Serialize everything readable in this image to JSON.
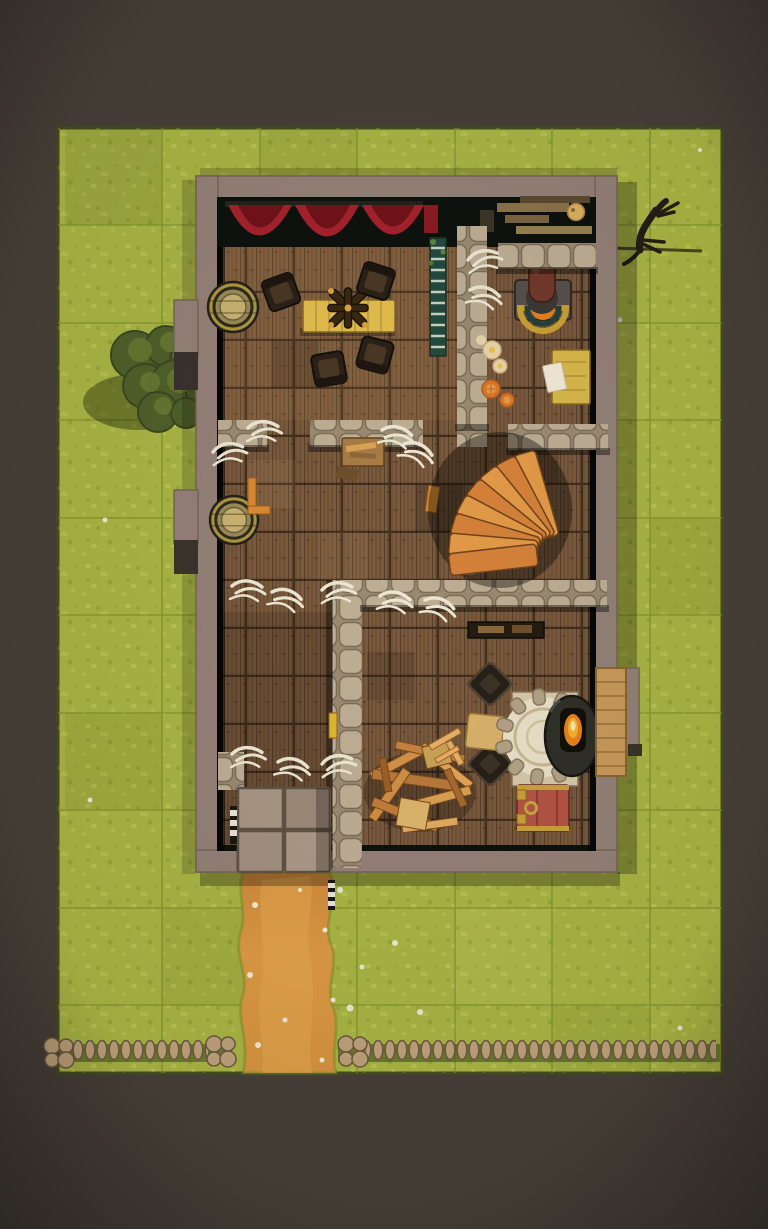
{
  "scene": {
    "description": "Top-down fantasy tavern battle map on a grass field with square grid, dirt path, stone fence, bush and lizard"
  },
  "colors": {
    "backdrop": "#474038",
    "grass": "#a9b544",
    "grass_edge": "#454e20",
    "grid_line": "#7f922c",
    "path": "#d79440",
    "path_light": "#e3a74f",
    "wall": "#93histogram",
    "wall_face": "#94azz",
    "wall_fill": "#948077",
    "wall_shadow": "#3a332c",
    "interior_dark": "#0e100c",
    "floor_wood": "#7b5a3d",
    "stone_mortar": "#9a8a72",
    "stone_face": "#bdae94",
    "curtain": "#a5222c",
    "curtain_dark": "#701219",
    "table_wood": "#e2bd4e",
    "chair_dark": "#2c2118",
    "barrel_wood": "#9a8a58",
    "stair_wood": "#e29a47",
    "copper_pipe": "#73392a",
    "fire": "#e8821c",
    "hearth_base": "#d6c9a8",
    "hearth_inner": "#e9e0c8",
    "stove_iron": "#2f3028",
    "trapdoor_red": "#b35544",
    "brass_trim": "#c9a23c",
    "bench_wood": "#c9995a",
    "slab_stone": "#a29080",
    "fence_stone": "#bfa27b",
    "tree_foliage": "#4f602a",
    "tree_highlight": "#687a33",
    "lizard": "#241f15",
    "bone": "#ece6d2",
    "plate": "#e9d3a9",
    "orange_fruit": "#d9782a",
    "paper": "#f2ead6",
    "cheese": "#d9b061",
    "ladder_teal": "#24493d",
    "shelf_wood": "#8a7348"
  },
  "objects": {
    "creature": "lizard",
    "vegetation": "bush-tree",
    "terrain": [
      "grass-field",
      "dirt-path",
      "stone-fence",
      "entrance-slabs"
    ],
    "structure": [
      "stone-outer-walls",
      "interior-stone-walls",
      "wood-plank-floor",
      "wall-chimneys"
    ],
    "furnishings": [
      "red-curtains",
      "wall-shelves",
      "cheese-wheel",
      "forge-with-copper-pipe",
      "teal-ladder",
      "dining-table",
      "chandelier",
      "armchairs",
      "barrels",
      "food-plates",
      "orange-slices",
      "writing-table",
      "paper-sheet",
      "spiral-staircase",
      "stone-hearth",
      "iron-stove",
      "wood-bench",
      "trapdoor",
      "broken-furniture-pile",
      "bone-scatter",
      "work-bench"
    ]
  }
}
